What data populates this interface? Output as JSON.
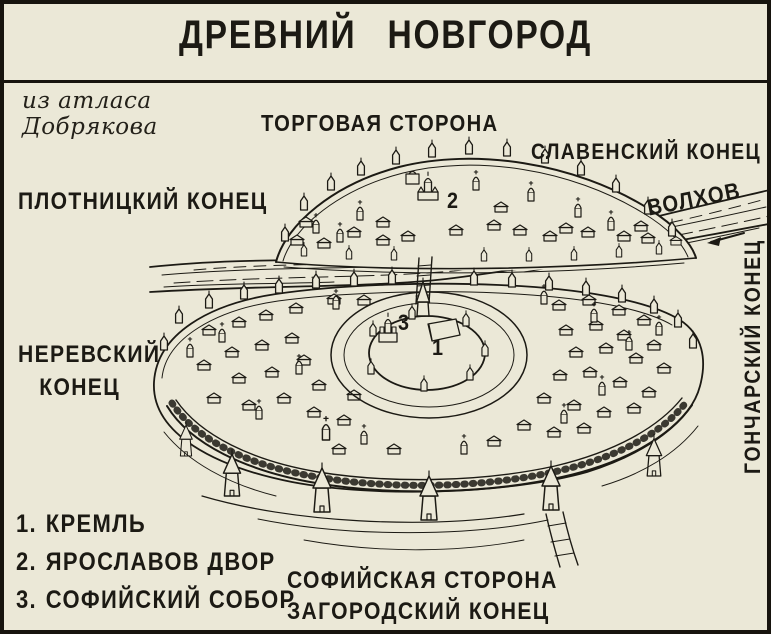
{
  "title": "ДРЕВНИЙ НОВГОРОД",
  "attribution": {
    "line1": "из атласа",
    "line2": "Добрякова"
  },
  "map": {
    "labels": {
      "torgovaya_storona": "ТОРГОВАЯ СТОРОНА",
      "slavensky_konets": "СЛАВЕНСКИЙ КОНЕЦ",
      "plotnitsky_konets": "ПЛОТНИЦКИЙ КОНЕЦ",
      "volkhov_river": "ВОЛХОВ",
      "goncharsky_konets": "ГОНЧАРСКИЙ КОНЕЦ",
      "nerevsky_konets_line1": "НЕРЕВСКИЙ",
      "nerevsky_konets_line2": "КОНЕЦ",
      "sofiyskaya_storona": "СОФИЙСКАЯ СТОРОНА",
      "zagorodsky_konets": "ЗАГОРОДСКИЙ КОНЕЦ"
    },
    "markers": {
      "kremlin": "1",
      "yaroslav_court": "2",
      "sofia_cathedral": "3"
    }
  },
  "legend": {
    "items": [
      {
        "number": "1.",
        "label": "КРЕМЛЬ"
      },
      {
        "number": "2.",
        "label": "ЯРОСЛАВОВ ДВОР"
      },
      {
        "number": "3.",
        "label": "СОФИЙСКИЙ СОБОР"
      }
    ]
  },
  "colors": {
    "paper": "#ebe8d7",
    "ink": "#1c1a14"
  }
}
